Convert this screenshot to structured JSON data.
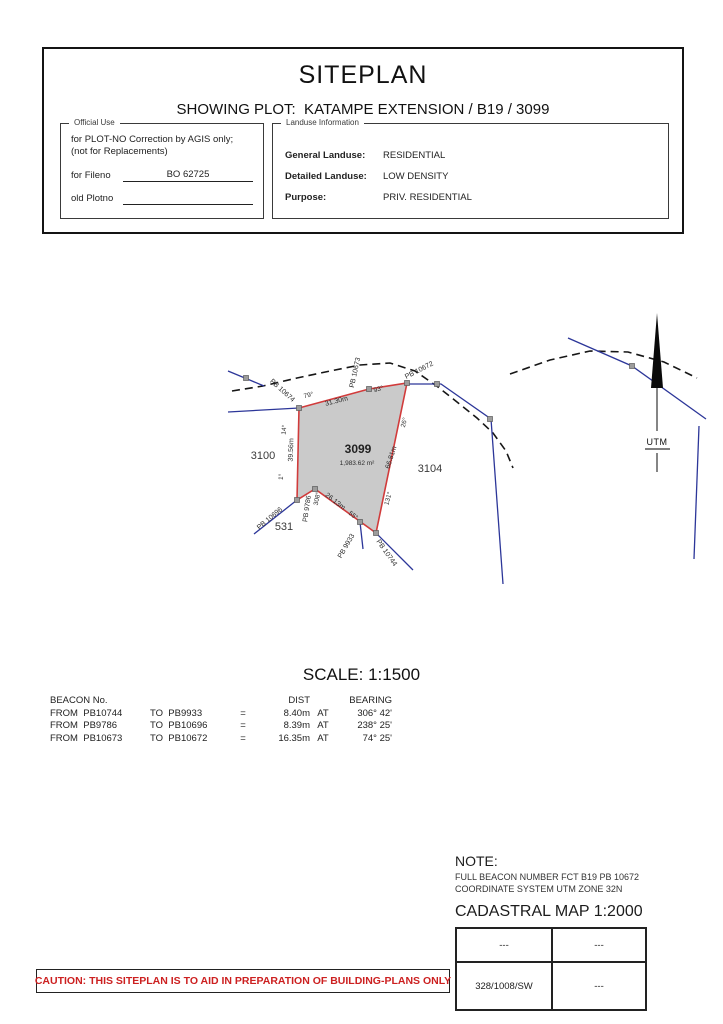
{
  "page": {
    "title": "SITEPLAN",
    "subtitle": "SHOWING PLOT:  KATAMPE EXTENSION / B19 / 3099"
  },
  "official_use": {
    "legend": "Official Use",
    "line1": "for PLOT-NO Correction by AGIS only;",
    "line2": "(not for Replacements)",
    "fileno_label": "for Fileno",
    "fileno_value": "BO 62725",
    "old_plotno_label": "old Plotno",
    "old_plotno_value": ""
  },
  "landuse": {
    "legend": "Landuse Information",
    "general_label": "General Landuse:",
    "general_value": "RESIDENTIAL",
    "detailed_label": "Detailed Landuse:",
    "detailed_value": "LOW DENSITY",
    "purpose_label": "Purpose:",
    "purpose_value": "PRIV. RESIDENTIAL"
  },
  "map": {
    "labels": {
      "pb10674": "PB 10674",
      "pb10673": "PB 10673",
      "pb10672": "PB 10672",
      "pb10696": "PB 10696",
      "pb9786": "PB 9786",
      "pb9933": "PB 9933",
      "pb10744": "PB 10744",
      "d3130": "31.30m",
      "d3956": "39.56m",
      "d6681": "66.81m",
      "d2613": "26.13m",
      "a79": "79°",
      "a93": "93°",
      "a14": "14°",
      "a1": "1°",
      "a26": "26°",
      "a131": "131°",
      "a308": "308°",
      "a55": "55°",
      "n3100": "3100",
      "n3104": "3104",
      "n531": "531",
      "p3099": "3099",
      "area": "1,983.62 m²",
      "utm": "UTM"
    }
  },
  "scale": "SCALE: 1:1500",
  "beacon_table": {
    "col_beacon": "BEACON No.",
    "col_dist": "DIST",
    "col_bearing": "BEARING",
    "rows": [
      [
        "FROM  PB10744",
        "TO  PB9933",
        "=",
        "8.40m",
        "AT",
        "306° 42'"
      ],
      [
        "FROM  PB9786",
        "TO  PB10696",
        "=",
        "8.39m",
        "AT",
        "238° 25'"
      ],
      [
        "FROM  PB10673",
        "TO  PB10672",
        "=",
        "16.35m",
        "AT",
        "74° 25'"
      ]
    ]
  },
  "note": {
    "heading": "NOTE:",
    "line1": "FULL BEACON NUMBER FCT B19 PB 10672",
    "line2": "COORDINATE SYSTEM UTM ZONE 32N"
  },
  "cadastral": {
    "title": "CADASTRAL MAP 1:2000",
    "rows": [
      [
        "---",
        "---"
      ],
      [
        "328/1008/SW",
        "---"
      ]
    ]
  },
  "caution": "CAUTION: THIS SITEPLAN IS TO AID IN PREPARATION OF BUILDING-PLANS ONLY"
}
